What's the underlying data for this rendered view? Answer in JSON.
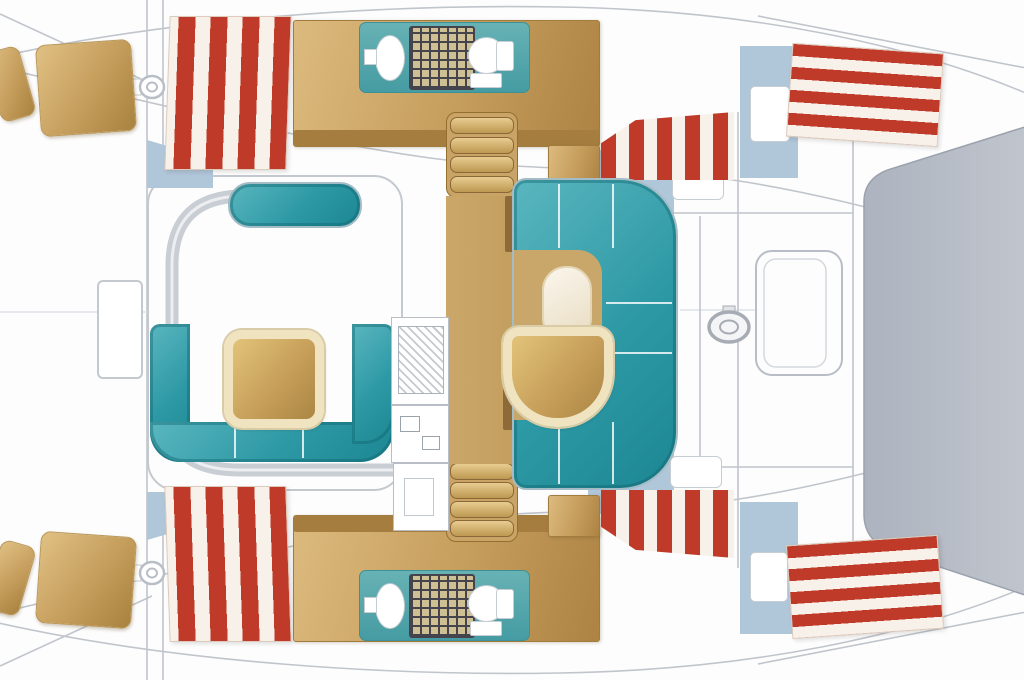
{
  "diagram": {
    "type": "catamaran-deck-plan",
    "orientation": {
      "bow": "left",
      "stern": "right"
    },
    "colors": {
      "upholstery_teal": "#2d99a5",
      "upholstery_teal_dark": "#177d89",
      "head_floor_teal": "#57aaae",
      "wood_light": "#e2c379",
      "wood_dark": "#a8823f",
      "mattress_stripe_red": "#bf3a28",
      "mattress_stripe_white": "#f8f1ea",
      "cabin_sole_blue": "#b0c6d9",
      "aft_platform_gray": "#b6bcc6",
      "hull_line_gray": "#c0c5cc",
      "table_border_cream": "#f0e3c0",
      "shower_grate_sand": "#cfc093",
      "shower_grate_line": "#45444d"
    },
    "hulls": {
      "port": {
        "forepeak_berths": 2,
        "forward_cabin": {
          "berth": "double-striped-mattress"
        },
        "head": {
          "fixtures": [
            "sink",
            "shower-grate",
            "toilet"
          ]
        },
        "companionway_steps": 4,
        "mid_cabin": {
          "berth": "striped-mattress",
          "furniture": [
            "shelf"
          ]
        },
        "aft_cabin": {
          "berth": "double-striped-mattress",
          "furniture": [
            "nightstand"
          ]
        }
      },
      "starboard": {
        "forepeak_berths": 2,
        "forward_cabin": {
          "berth": "double-striped-mattress"
        },
        "head": {
          "fixtures": [
            "sink",
            "shower-grate",
            "toilet"
          ]
        },
        "companionway_steps": 4,
        "mid_cabin": {
          "berth": "striped-mattress",
          "furniture": [
            "shelf"
          ]
        },
        "aft_cabin": {
          "berth": "double-striped-mattress",
          "furniture": [
            "nightstand"
          ]
        }
      }
    },
    "nacelle": {
      "forward_cockpit": {
        "furniture": [
          "bench",
          "u-shaped-sofa",
          "square-table"
        ]
      },
      "saloon": {
        "furniture": [
          "c-shaped-sofa",
          "d-shaped-table",
          "oval-stool"
        ],
        "galley": [
          "sink",
          "stove",
          "counter"
        ]
      },
      "aft_deck": {
        "furniture": [
          "helm-wheel",
          "cockpit-table"
        ],
        "platform": "aft-gray-platform"
      },
      "foredeck": {
        "features": [
          "hatch",
          "crossbeam",
          "deck-fittings"
        ]
      }
    }
  }
}
